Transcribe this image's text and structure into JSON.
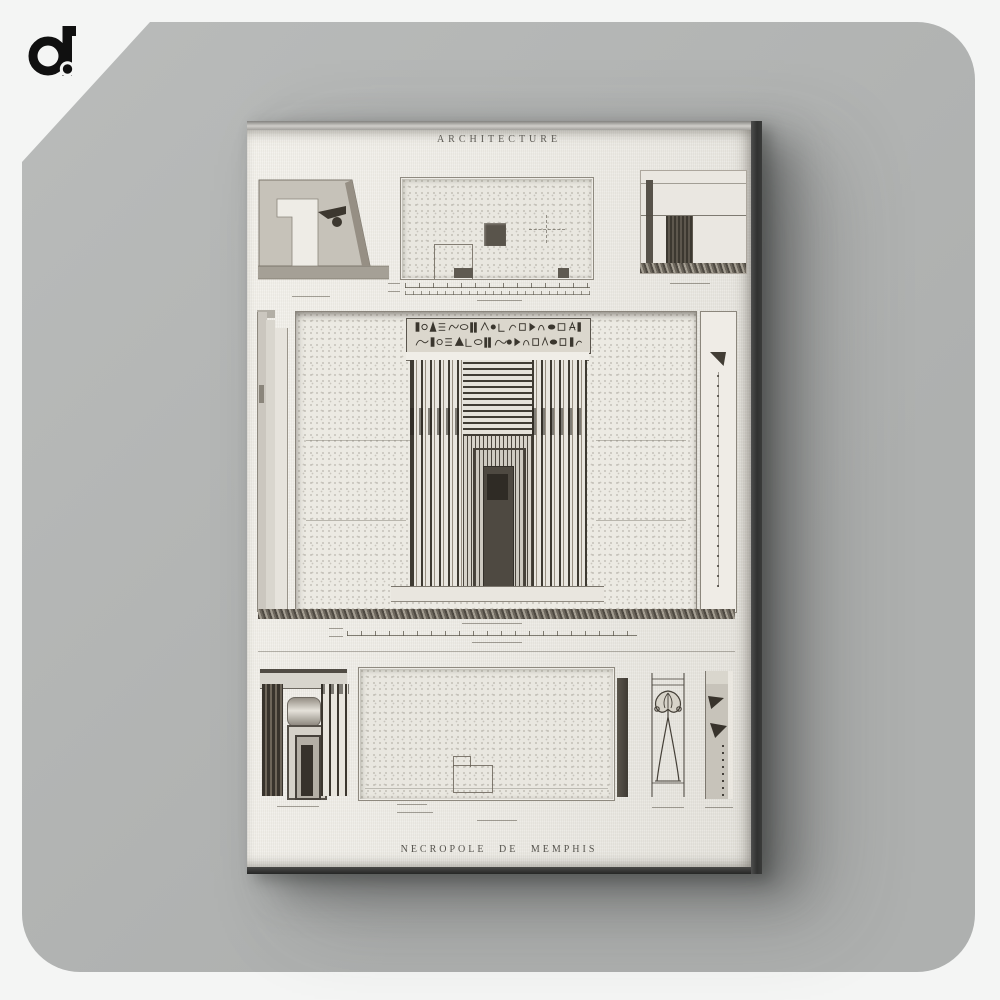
{
  "brand": {
    "logo_text": "a.",
    "logo_icon": "a-dot-logo",
    "logo_color": "#101010"
  },
  "artwork": {
    "header": "ARCHITECTURE",
    "footer": "NECROPOLE DE MEMPHIS"
  },
  "colors": {
    "page_bg": "#f4f5f4",
    "backdrop": "#b3b5b4",
    "canvas_face": "#ebe9e3",
    "canvas_side": "#343534",
    "engraving_ink": "#46423b"
  }
}
